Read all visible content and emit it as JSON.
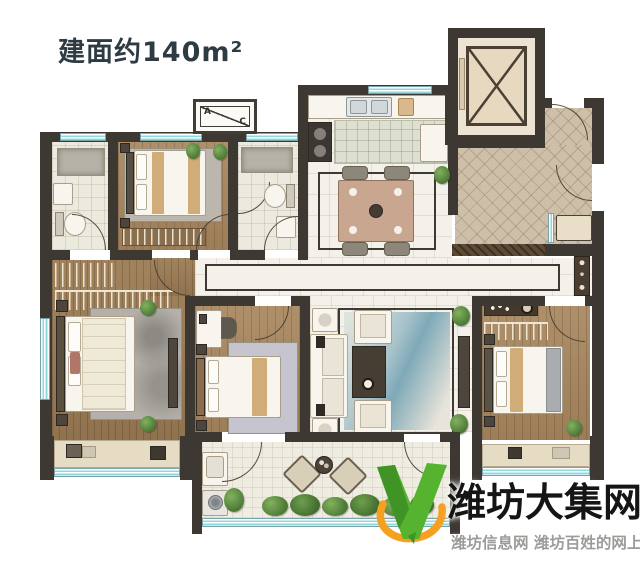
{
  "title": "建面约140m²",
  "ac_unit": {
    "a": "A",
    "c": "C"
  },
  "watermark": {
    "brand": "潍坊大集网",
    "tagline": "潍坊信息网 潍坊百姓的网上大集",
    "logo_icon": "v-swoosh-logo-icon"
  },
  "colors": {
    "wall": "#3e3833",
    "window": "#8fd8dc",
    "wood": "#a8875f",
    "wood-dark": "#9c7c55",
    "tile": "#f3f1ea",
    "bath-tile": "#eceadf",
    "entry-tile": "#cdbfa8",
    "furn": "#f8f5ee",
    "tan": "#c89f63",
    "rug-blue": "#a9c4cb",
    "brand-green": "#56b32f",
    "brand-green-dark": "#3f9425",
    "brand-orange": "#f6a021",
    "title-color": "#2e3b43",
    "tagline-color": "#9b9b97",
    "brand-black": "#151515"
  }
}
